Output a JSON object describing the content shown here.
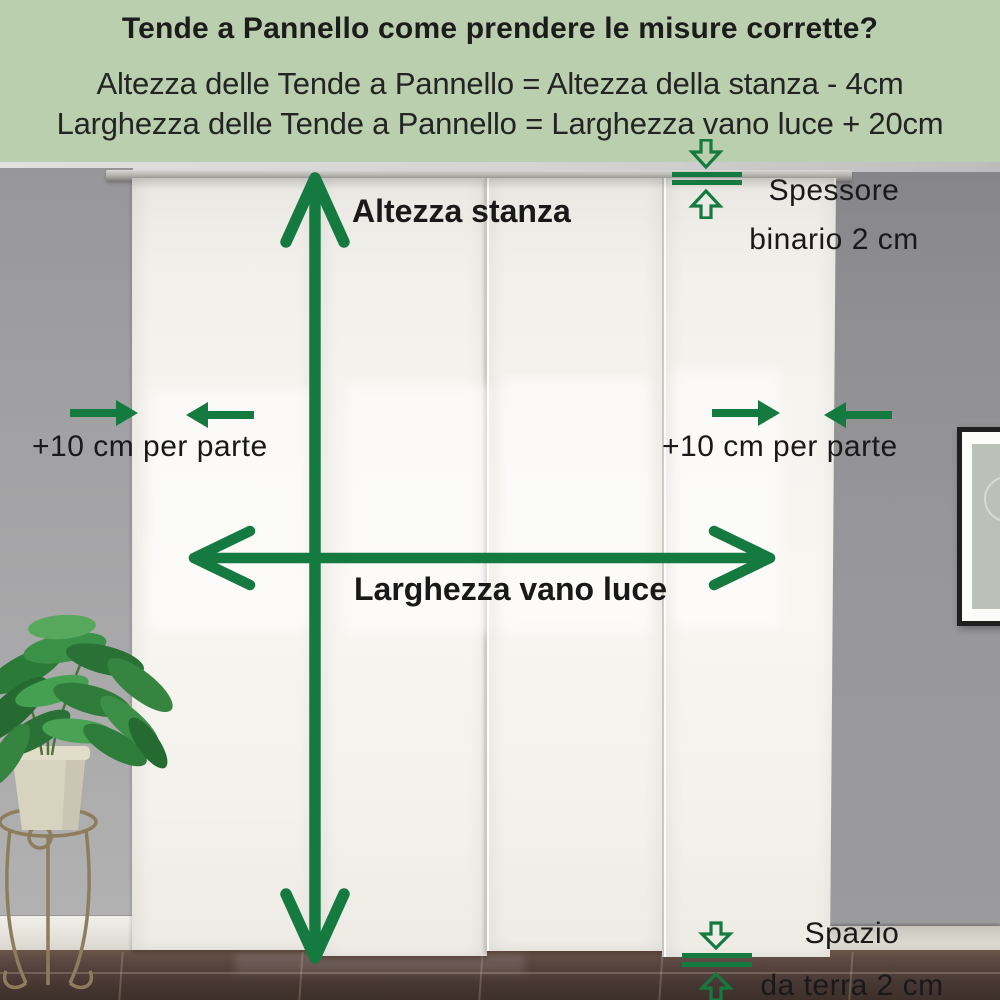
{
  "header": {
    "bg_color": "#b9cfae",
    "title": "Tende a Pannello come prendere le misure corrette?",
    "formula_height": "Altezza delle Tende a Pannello = Altezza della stanza - 4cm",
    "formula_width": "Larghezza delle Tende a Pannello = Larghezza vano luce + 20cm"
  },
  "annotations": {
    "arrow_color": "#157a40",
    "text_color": "#191919",
    "room_height": {
      "label": "Altezza stanza"
    },
    "opening_width": {
      "label": "Larghezza vano luce"
    },
    "side_allowance_left": {
      "label": "+10 cm per parte"
    },
    "side_allowance_right": {
      "label": "+10 cm per parte"
    },
    "track_thickness": {
      "line1": "Spessore",
      "line2": "binario 2 cm"
    },
    "floor_gap": {
      "line1": "Spazio",
      "line2": "da terra 2 cm"
    }
  },
  "scene": {
    "colors": {
      "wall_left": "#a3a3a5",
      "wall_right": "#939396",
      "ceiling": "#d6d6d8",
      "curtain": "#f6f4ef",
      "rail": "#a9a8a6",
      "baseboard": "#dddad2",
      "floor": "#4e3c33",
      "plant_foliage": "#3a8a45",
      "plant_pot": "#d7d3bf",
      "stand_metal": "#8d7d5c",
      "frame": "#1f1f1f"
    }
  }
}
